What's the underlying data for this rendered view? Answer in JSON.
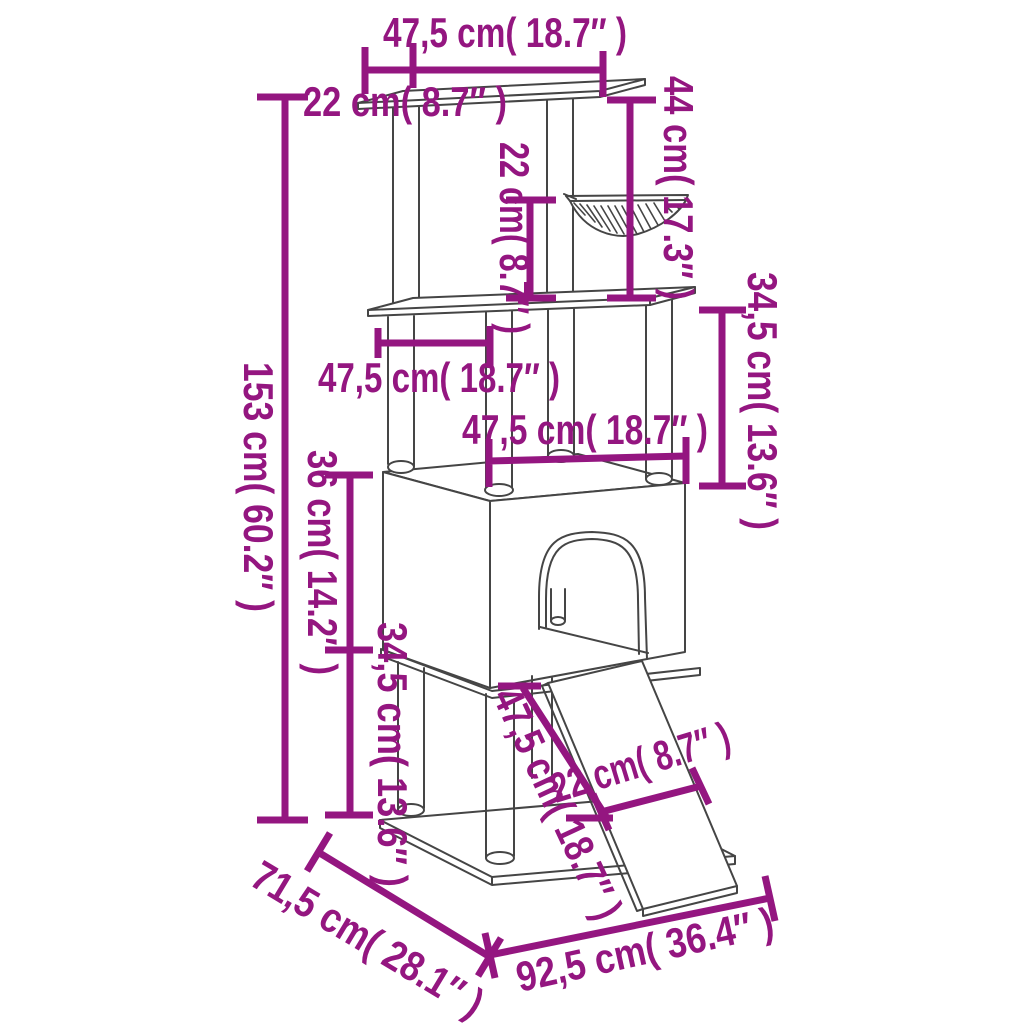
{
  "page": {
    "type": "product-dimension-diagram",
    "subject": "cat-tree-with-hammock-house-and-ramp"
  },
  "colors": {
    "dimension-magenta": "#941680",
    "line-gray": "#454545",
    "background-white": "#ffffff"
  },
  "dimensions": {
    "top_platform_width": "47,5 cm( 18.7″ )",
    "top_platform_depth": "22 cm( 8.7″ )",
    "overall_height": "153 cm( 60.2″ )",
    "top_section_height": "44 cm( 17.3″ )",
    "hammock_to_shelf_height": "22 cm( 8.7″ )",
    "middle_shelf_width": "47,5 cm( 18.7″ )",
    "house_top_width": "47,5 cm( 18.7″ )",
    "shelf_to_house_height": "34,5 cm( 13.6″ )",
    "house_height": "36 cm( 14.2″ )",
    "lower_section_height": "34,5 cm( 13.6″ )",
    "ramp_length": "47,5 cm( 18.7″ )",
    "ramp_width": "22 cm( 8.7″ )",
    "base_depth": "71,5 cm( 28.1″ )",
    "base_width": "92,5 cm( 36.4″ )"
  }
}
